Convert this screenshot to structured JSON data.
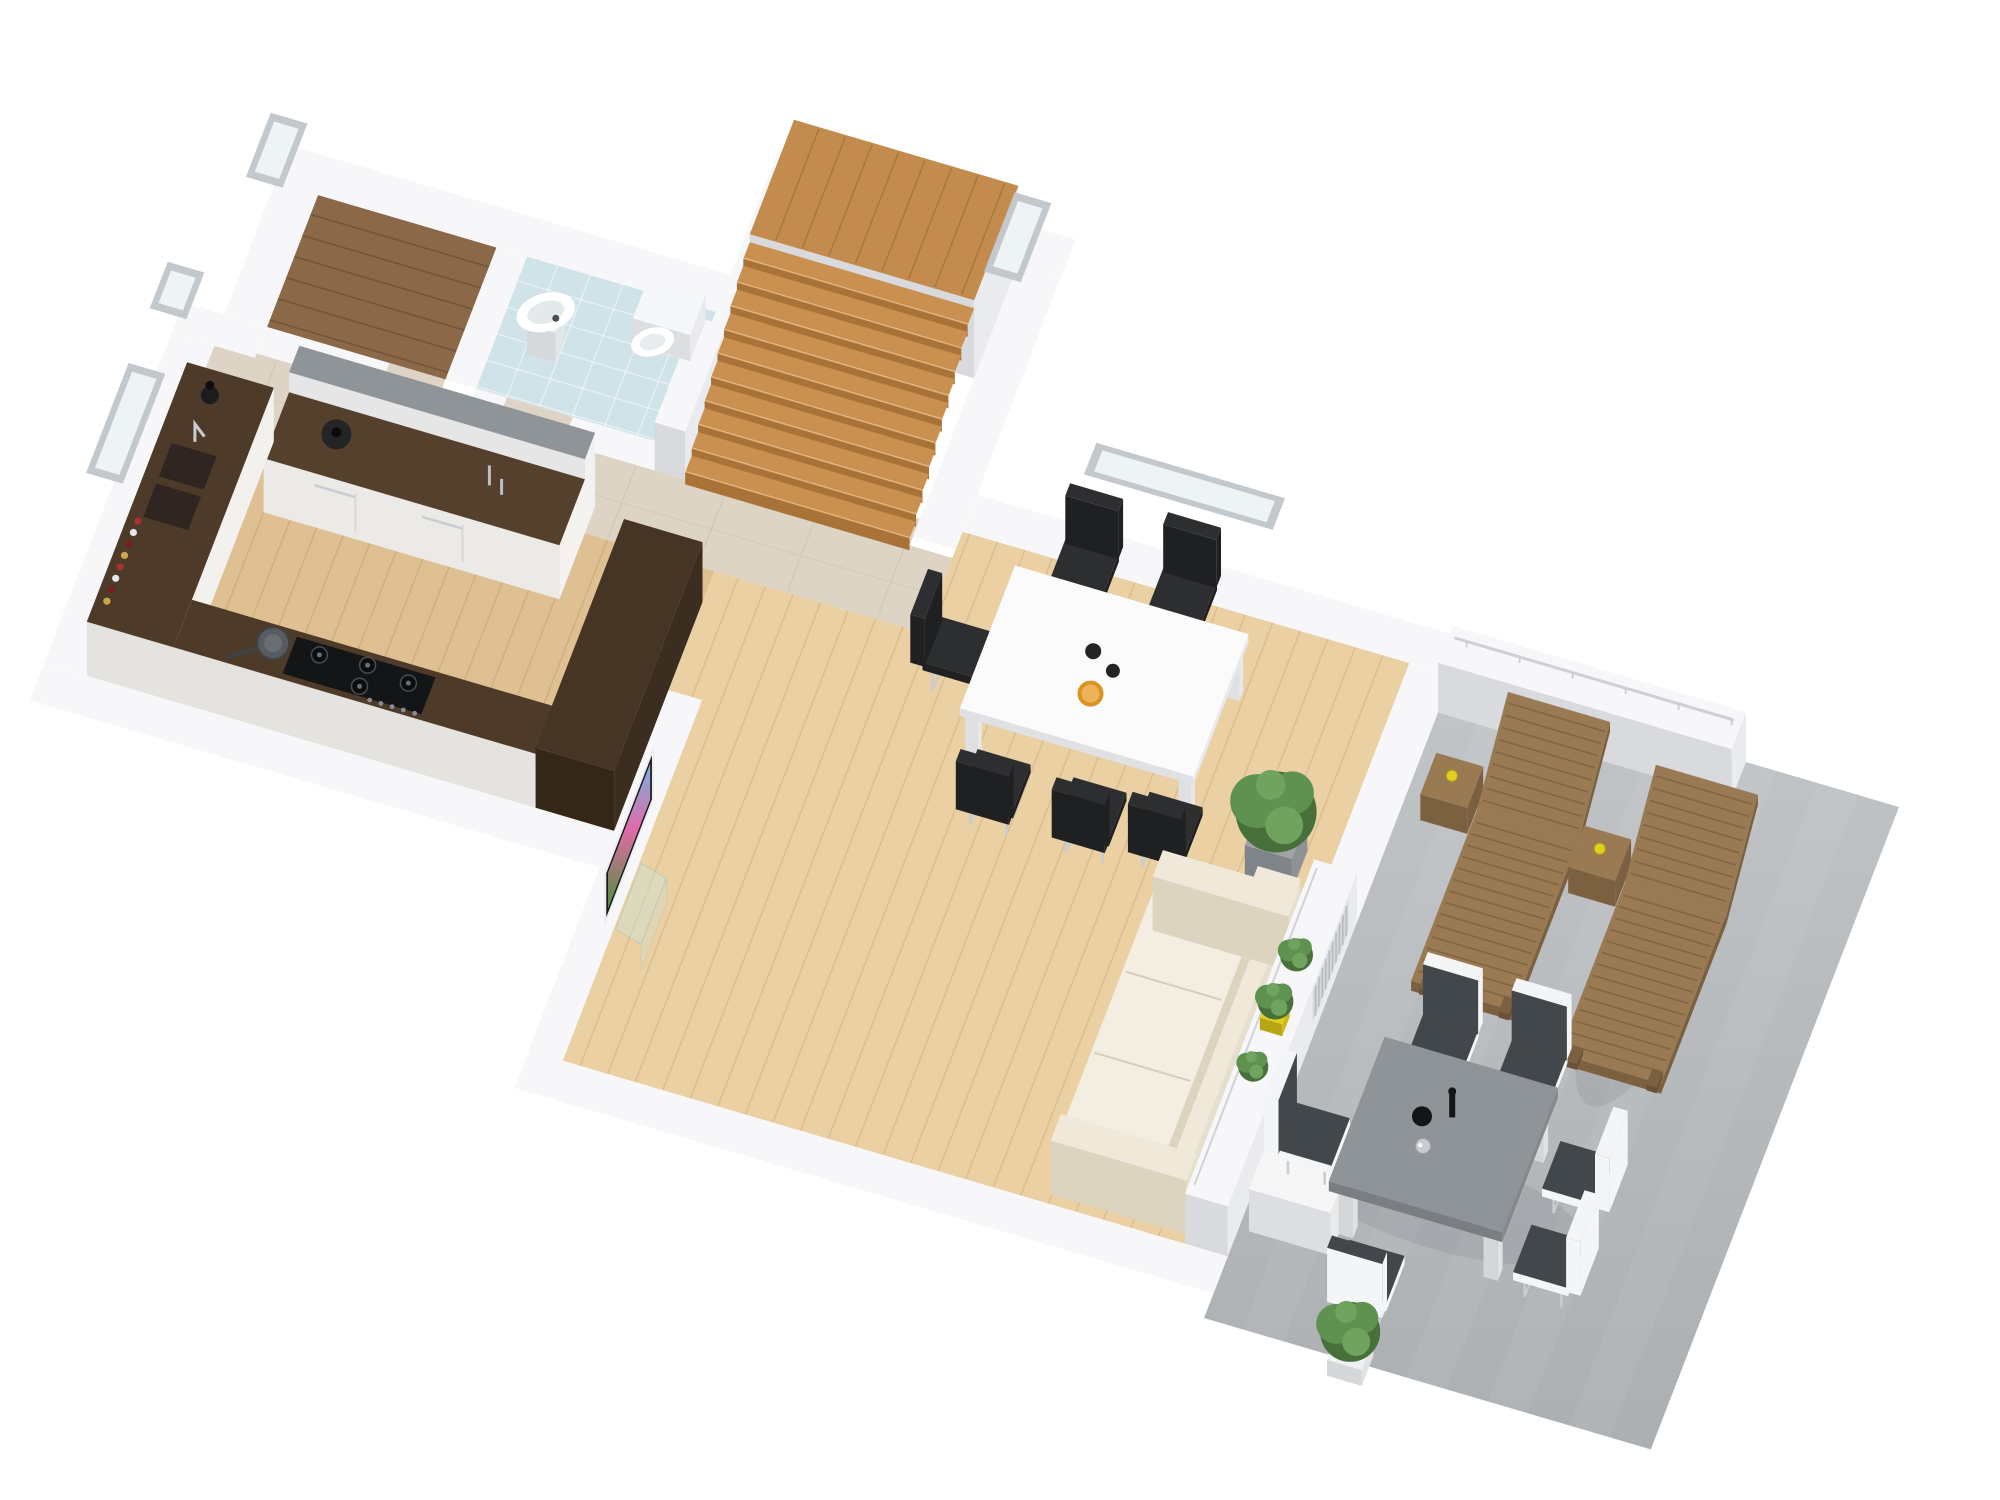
{
  "meta": {
    "description": "3D isometric floor plan rendering of a single-storey home: hallway, closet, bathroom, staircase, kitchen, open-plan living and dining room, and an outdoor concrete patio with furniture",
    "view": "isometric bird's eye",
    "background": "#ffffff",
    "visible_text": ""
  },
  "palette": {
    "wall_top": "#f7f7f9",
    "wall_east": "#e9ebee",
    "wall_south": "#d8dade",
    "floor_living": "#ead0a2",
    "floor_kitchen": "#dfc092",
    "travertine": "#ded4c6",
    "closet_wood": "#8b6847",
    "bath_floor": "#cfe3e8",
    "stair_top": "#c9904f",
    "stair_riser": "#a97338",
    "landing": "#c38b4d",
    "concrete": "#c2c5c8",
    "concrete_dark": "#acafb2",
    "counter_brown": "#4e3a28",
    "counter_front": "#f2f1ee",
    "bar_brown": "#463525",
    "bar_dark": "#352718",
    "gray_counter": "#8f9498",
    "island_top": "#54402c",
    "chrome": "#c9cdd1",
    "sofa": "#f0e9da",
    "sofa_shadow": "#ddd4c0",
    "chair_black": "#2d2e30",
    "chair_dark": "#1f2022",
    "table_white": "#fbfbfc",
    "out_table": "#8f9499",
    "out_table_dark": "#797e82",
    "out_chair": "#42474b",
    "out_chair_white": "#f4f5f6",
    "lounger": "#9a7a52",
    "lounger_dark": "#7c6140",
    "plant": "#5f9150",
    "plant_dark": "#47703a",
    "plant_light": "#6fa35e",
    "pot_gray": "#9ea3a7",
    "pot_yellow": "#e3cf1d",
    "accent_orange": "#d9931f",
    "tv_frame": "#ececee",
    "tv_black": "#17181b",
    "glass": "#cfe4dd",
    "window_glass": "#eef3f6",
    "window_frame": "#c3c8cd",
    "hob_black": "#141517",
    "shadow": "rgba(60,65,75,0.10)"
  },
  "rooms": [
    {
      "id": "closet",
      "floor": "dark-wood-planks",
      "features": [
        "window"
      ]
    },
    {
      "id": "hallway",
      "floor": "travertine-tile",
      "features": [
        "window"
      ]
    },
    {
      "id": "bathroom",
      "floor": "light-blue-tile",
      "fixtures": [
        "pedestal-sink",
        "toilet"
      ]
    },
    {
      "id": "staircase",
      "floor": "oak",
      "features": [
        "upper-landing",
        "ten-steps",
        "window"
      ]
    },
    {
      "id": "kitchen",
      "floor": "oak-planks",
      "furniture": [
        "wall-counter-with-double-sink",
        "spice-jars",
        "black-vase",
        "frying-pan",
        "gas-hob",
        "island-cabinet-with-pot-and-bottles",
        "gray-top-counter",
        "dark-bar-counter"
      ],
      "features": [
        "window"
      ]
    },
    {
      "id": "living-dining-room",
      "floor": "light-oak-planks",
      "furniture": [
        "white-dining-table",
        "six-black-cantilever-chairs",
        "two-black-bowls",
        "orange-bowl",
        "wall-tv",
        "glass-tv-stand",
        "cream-three-seat-sofa",
        "large-potted-plant",
        "ledge-plants-one-yellow-pot",
        "radiator"
      ]
    },
    {
      "id": "patio",
      "floor": "concrete",
      "furniture": [
        "two-wooden-sun-loungers",
        "two-lounger-side-tables-with-yellow-drinks",
        "gray-outdoor-dining-table",
        "six-outdoor-chairs",
        "black-round-vase",
        "tall-black-vase",
        "chrome-vase",
        "white-bench-box",
        "potted-shrub",
        "railing-low-wall"
      ]
    }
  ]
}
